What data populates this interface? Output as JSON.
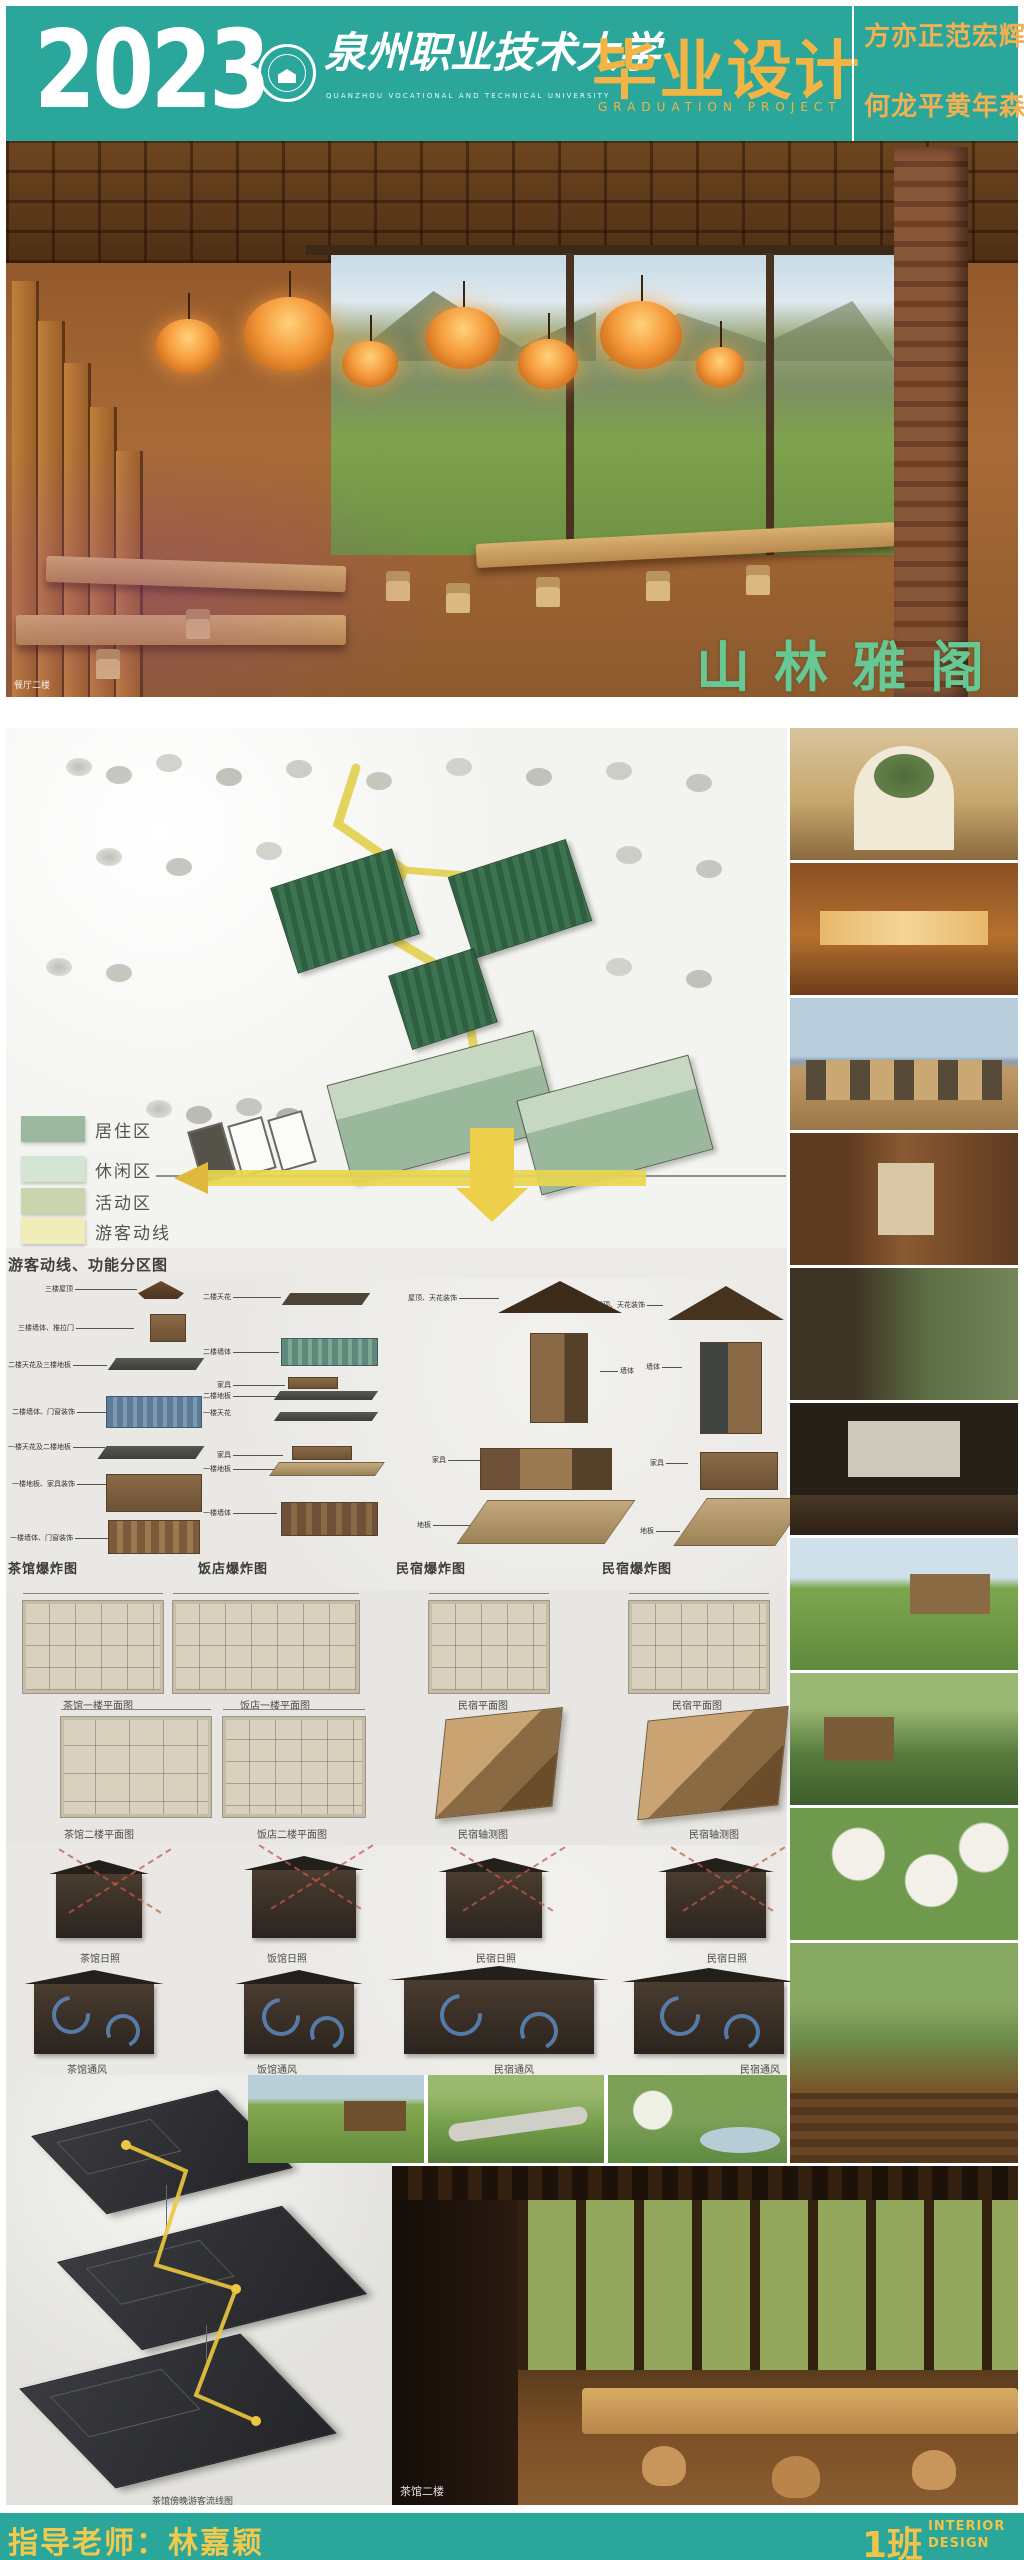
{
  "header": {
    "year": "2023",
    "university_cn": "泉州职业技术大学",
    "university_en": "QUANZHOU VOCATIONAL AND TECHNICAL UNIVERSITY",
    "title_cn": "毕业设计",
    "title_en": "GRADUATION PROJECT",
    "students_line1": "方亦正范宏辉",
    "students_line2": "何龙平黄年森"
  },
  "hero": {
    "project_name": "山林雅阁",
    "photo_label": "餐厅二楼"
  },
  "siteplan": {
    "legend": [
      {
        "label": "居住区",
        "color": "#9cb9a0"
      },
      {
        "label": "休闲区",
        "color": "#d4e6d3"
      },
      {
        "label": "活动区",
        "color": "#c9d6ad"
      },
      {
        "label": "游客动线",
        "color": "#f1edb9"
      }
    ],
    "caption": "游客动线、功能分区图"
  },
  "exploded": {
    "captions": [
      "茶馆爆炸图",
      "饭店爆炸图",
      "民宿爆炸图",
      "民宿爆炸图"
    ],
    "tea_labels": [
      "三楼屋顶",
      "三楼墙体、推拉门",
      "二楼天花及三楼地板",
      "二楼墙体、门窗装饰",
      "一楼天花及二楼地板",
      "一楼地板、家具装饰",
      "一楼墙体、门窗装饰"
    ],
    "restaurant_labels": [
      "二楼天花",
      "二楼墙体",
      "家具",
      "二楼地板",
      "一楼天花",
      "家具",
      "一楼地板",
      "一楼墙体"
    ],
    "minsu_labels": [
      "屋顶、天花装饰",
      "墙体",
      "家具",
      "地板"
    ],
    "minsu2_labels": [
      "屋顶、天花装饰",
      "墙体",
      "家具",
      "地板"
    ]
  },
  "plans": {
    "row1_captions": [
      "茶馆一楼平面图",
      "饭店一楼平面图",
      "民宿平面图",
      "民宿平面图"
    ],
    "row2_captions": [
      "茶馆二楼平面图",
      "饭店二楼平面图",
      "民宿轴测图",
      "民宿轴测图"
    ]
  },
  "analysis": {
    "sun_captions": [
      "茶馆日照",
      "饭馆日照",
      "民宿日照",
      "民宿日照"
    ],
    "wind_captions": [
      "茶馆通风",
      "饭馆通风",
      "民宿通风",
      "民宿通风"
    ]
  },
  "flow": {
    "caption": "茶馆傍晚游客流线图"
  },
  "big_photo": {
    "label": "茶馆二楼"
  },
  "footer": {
    "advisor": "指导老师：林嘉颖",
    "class_no": "1班",
    "dept_line1": "INTERIOR",
    "dept_line2": "DESIGN"
  },
  "colors": {
    "teal": "#2aa69b",
    "accent_yellow": "#f2b545",
    "title_green": "#67c893",
    "route_yellow": "#e3d254"
  }
}
